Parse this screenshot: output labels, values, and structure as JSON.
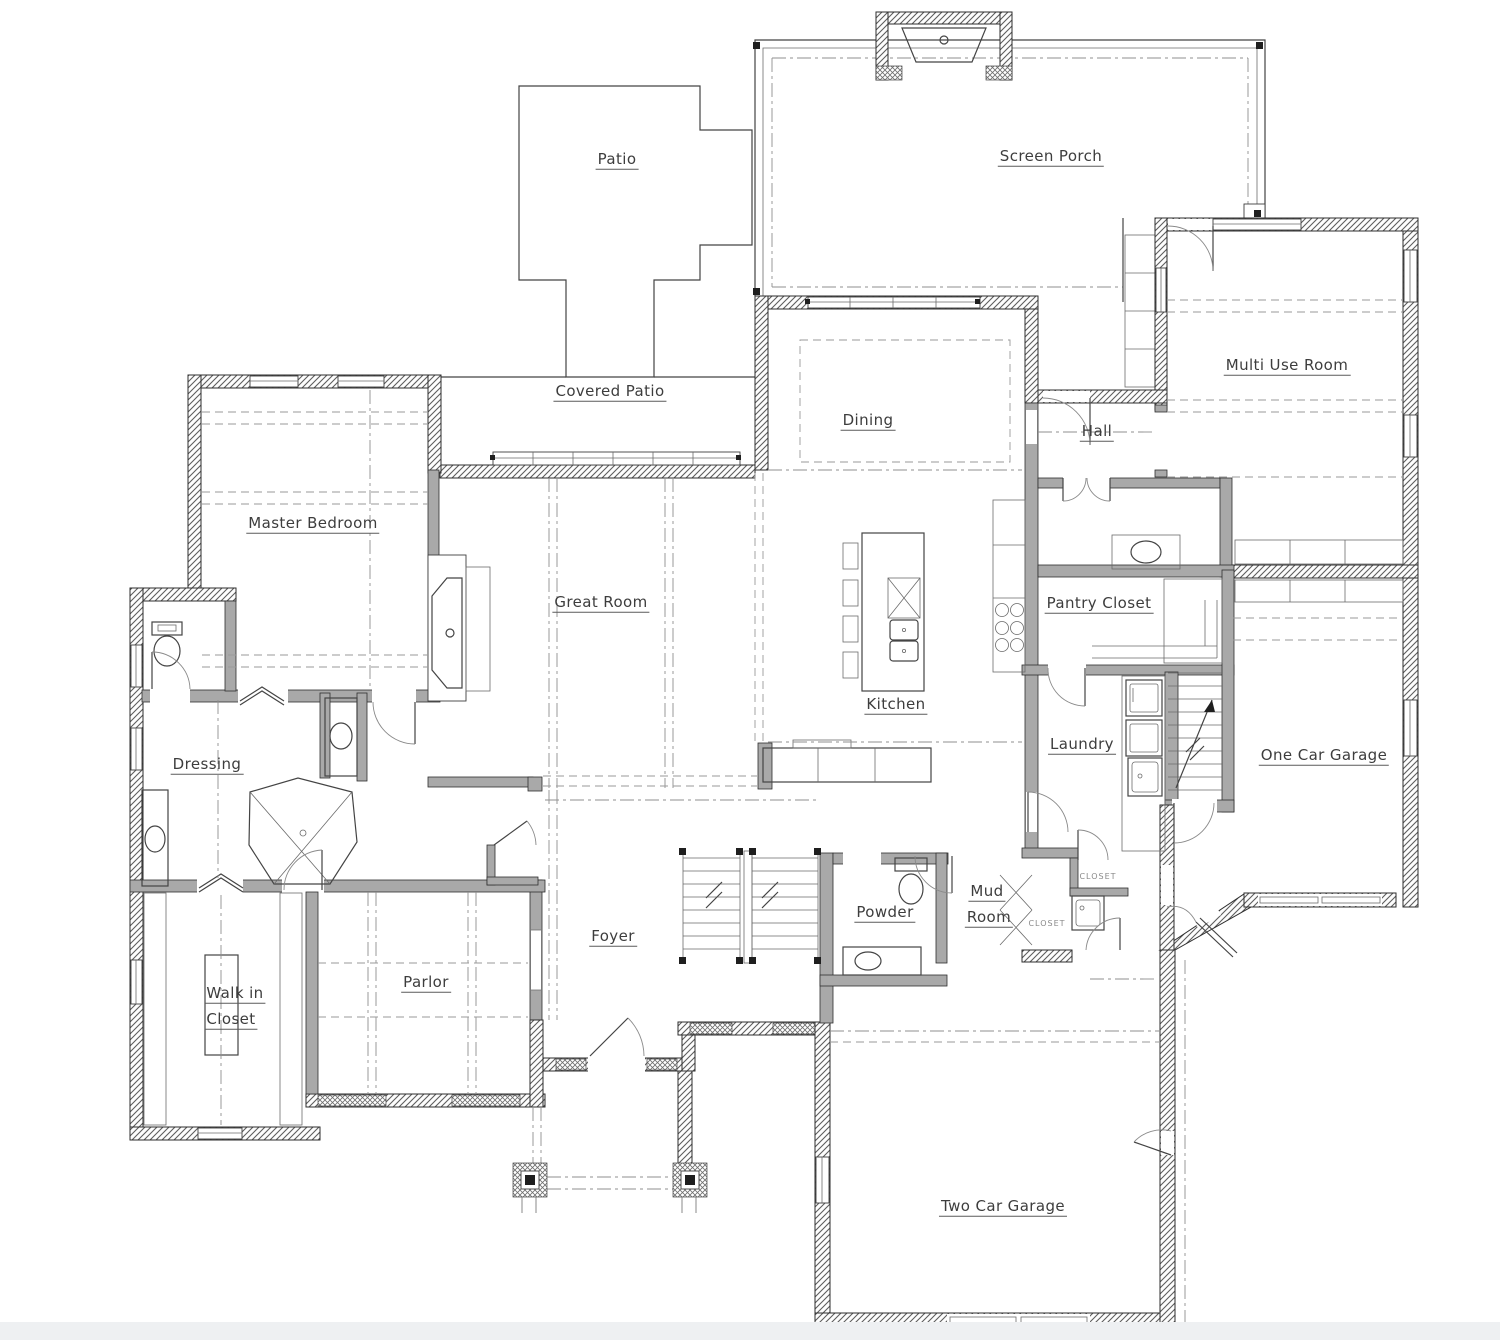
{
  "rooms": {
    "patio": "Patio",
    "screen_porch": "Screen Porch",
    "covered_patio": "Covered Patio",
    "multi_use": "Multi Use Room",
    "master_bedroom": "Master Bedroom",
    "dining": "Dining",
    "hall": "Hall",
    "great_room": "Great Room",
    "pantry": "Pantry Closet",
    "kitchen": "Kitchen",
    "laundry": "Laundry",
    "one_car_garage": "One Car Garage",
    "dressing": "Dressing",
    "powder": "Powder",
    "mud_line1": "Mud",
    "mud_line2": "Room",
    "walk_in_line1": "Walk in",
    "walk_in_line2": "Closet",
    "parlor": "Parlor",
    "foyer": "Foyer",
    "two_car_garage": "Two Car Garage",
    "closet": "CLOSET"
  },
  "colors": {
    "background": "#ffffff",
    "exterior_wall_hatch": "#5d5d5d",
    "interior_wall_fill": "#a9a9a9",
    "line": "#444444",
    "label_text": "#3d3d3d"
  }
}
